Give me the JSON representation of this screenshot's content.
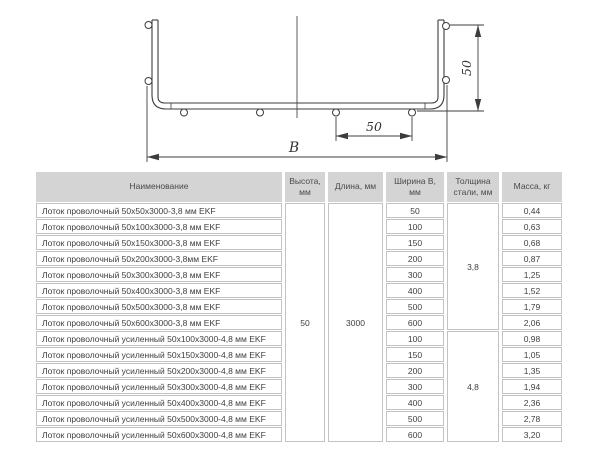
{
  "drawing": {
    "labels": {
      "overall_width": "B",
      "wire_pitch_mm": "50",
      "side_height_mm": "50"
    }
  },
  "table": {
    "headers": [
      "Наименование",
      "Высота, мм",
      "Длина, мм",
      "Ширина В, мм",
      "Толщина стали, мм",
      "Масса, кг"
    ],
    "height_mm": "50",
    "length_mm": "3000",
    "thickness_standard": "3,8",
    "thickness_reinforced": "4,8",
    "rows": [
      {
        "name": "Лоток проволочный 50x50x3000-3,8 мм EKF",
        "width": "50",
        "mass": "0,44"
      },
      {
        "name": "Лоток проволочный 50x100x3000-3,8 мм EKF",
        "width": "100",
        "mass": "0,63"
      },
      {
        "name": "Лоток проволочный 50x150x3000-3,8 мм EKF",
        "width": "150",
        "mass": "0,68"
      },
      {
        "name": "Лоток проволочный 50x200x3000-3,8мм EKF",
        "width": "200",
        "mass": "0,87"
      },
      {
        "name": "Лоток проволочный 50x300x3000-3,8 мм EKF",
        "width": "300",
        "mass": "1,25"
      },
      {
        "name": "Лоток проволочный 50x400x3000-3,8 мм EKF",
        "width": "400",
        "mass": "1,52"
      },
      {
        "name": "Лоток проволочный 50x500x3000-3,8 мм EKF",
        "width": "500",
        "mass": "1,79"
      },
      {
        "name": "Лоток проволочный 50x600x3000-3,8 мм EKF",
        "width": "600",
        "mass": "2,06"
      },
      {
        "name": "Лоток проволочный усиленный 50x100x3000-4,8 мм EKF",
        "width": "100",
        "mass": "0,98"
      },
      {
        "name": "Лоток проволочный усиленный 50x150x3000-4,8 мм EKF",
        "width": "150",
        "mass": "1,05"
      },
      {
        "name": "Лоток проволочный усиленный 50x200x3000-4,8 мм EKF",
        "width": "200",
        "mass": "1,35"
      },
      {
        "name": "Лоток проволочный усиленный 50x300x3000-4,8 мм EKF",
        "width": "300",
        "mass": "1,94"
      },
      {
        "name": "Лоток проволочный усиленный 50x400x3000-4,8 мм EKF",
        "width": "400",
        "mass": "2,36"
      },
      {
        "name": "Лоток проволочный усиленный 50x500x3000-4,8 мм EKF",
        "width": "500",
        "mass": "2,78"
      },
      {
        "name": "Лоток проволочный усиленный 50x600x3000-4,8 мм EKF",
        "width": "600",
        "mass": "3,20"
      }
    ]
  }
}
